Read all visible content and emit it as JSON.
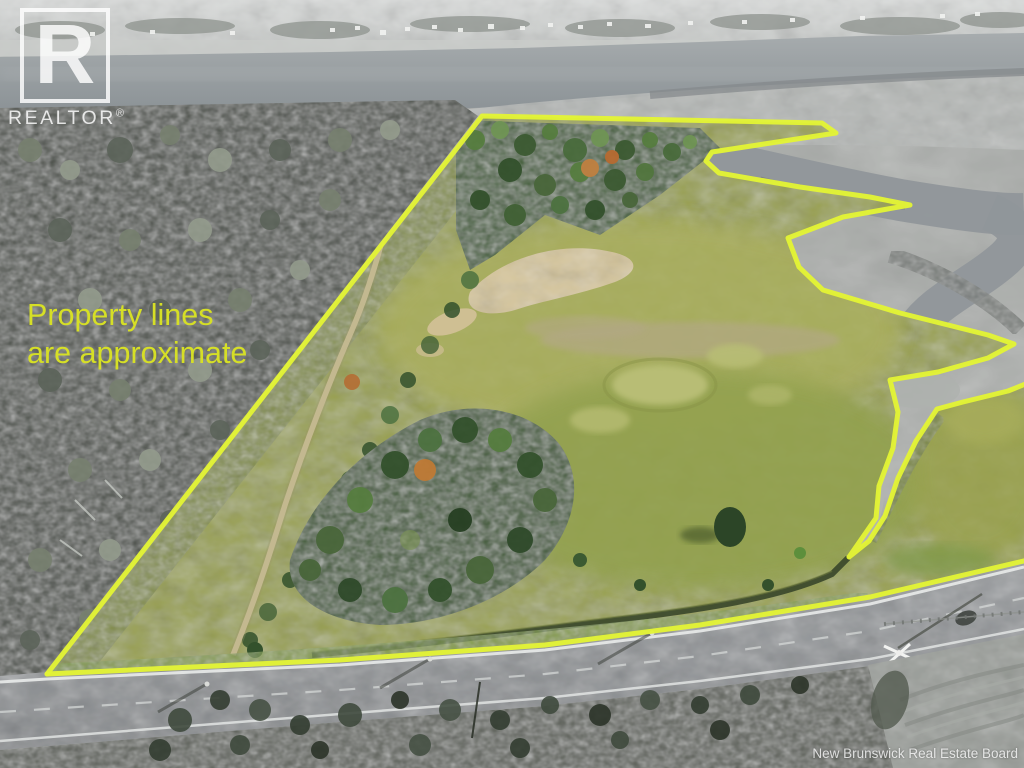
{
  "branding": {
    "logo_letter": "R",
    "logo_text": "REALTOR",
    "registered_mark": "®"
  },
  "disclaimer": {
    "line1": "Property lines",
    "line2": "are approximate",
    "color": "#d6df26"
  },
  "watermark": {
    "text": "New Brunswick Real Estate Board"
  },
  "annotation": {
    "line_color": "#e4f434",
    "outline_points": "47,674 482,116 822,123 836,133 712,152 706,161 719,173 800,187 870,197 910,205 843,217 788,238 799,267 823,290 900,313 988,335 1014,344 988,358 938,372 890,380 898,412 893,448 879,486 876,518 858,544 849,557 869,541 885,516 898,478 916,441 937,409 963,402 1008,391 1028,383",
    "road_points": "47,674 340,660 545,645 700,625 870,597 1028,560",
    "fill_points": "47,674 482,116 822,123 836,133 712,152 706,161 719,173 800,187 870,197 910,205 843,217 788,238 799,267 823,290 900,313 988,335 1014,344 988,358 938,372 890,380 898,412 893,448 879,486 876,518 858,544 849,557 869,541 885,516 898,478 916,441 937,409 963,402 1008,391 1028,383 1028,560 870,597 700,625 545,645 340,660"
  }
}
